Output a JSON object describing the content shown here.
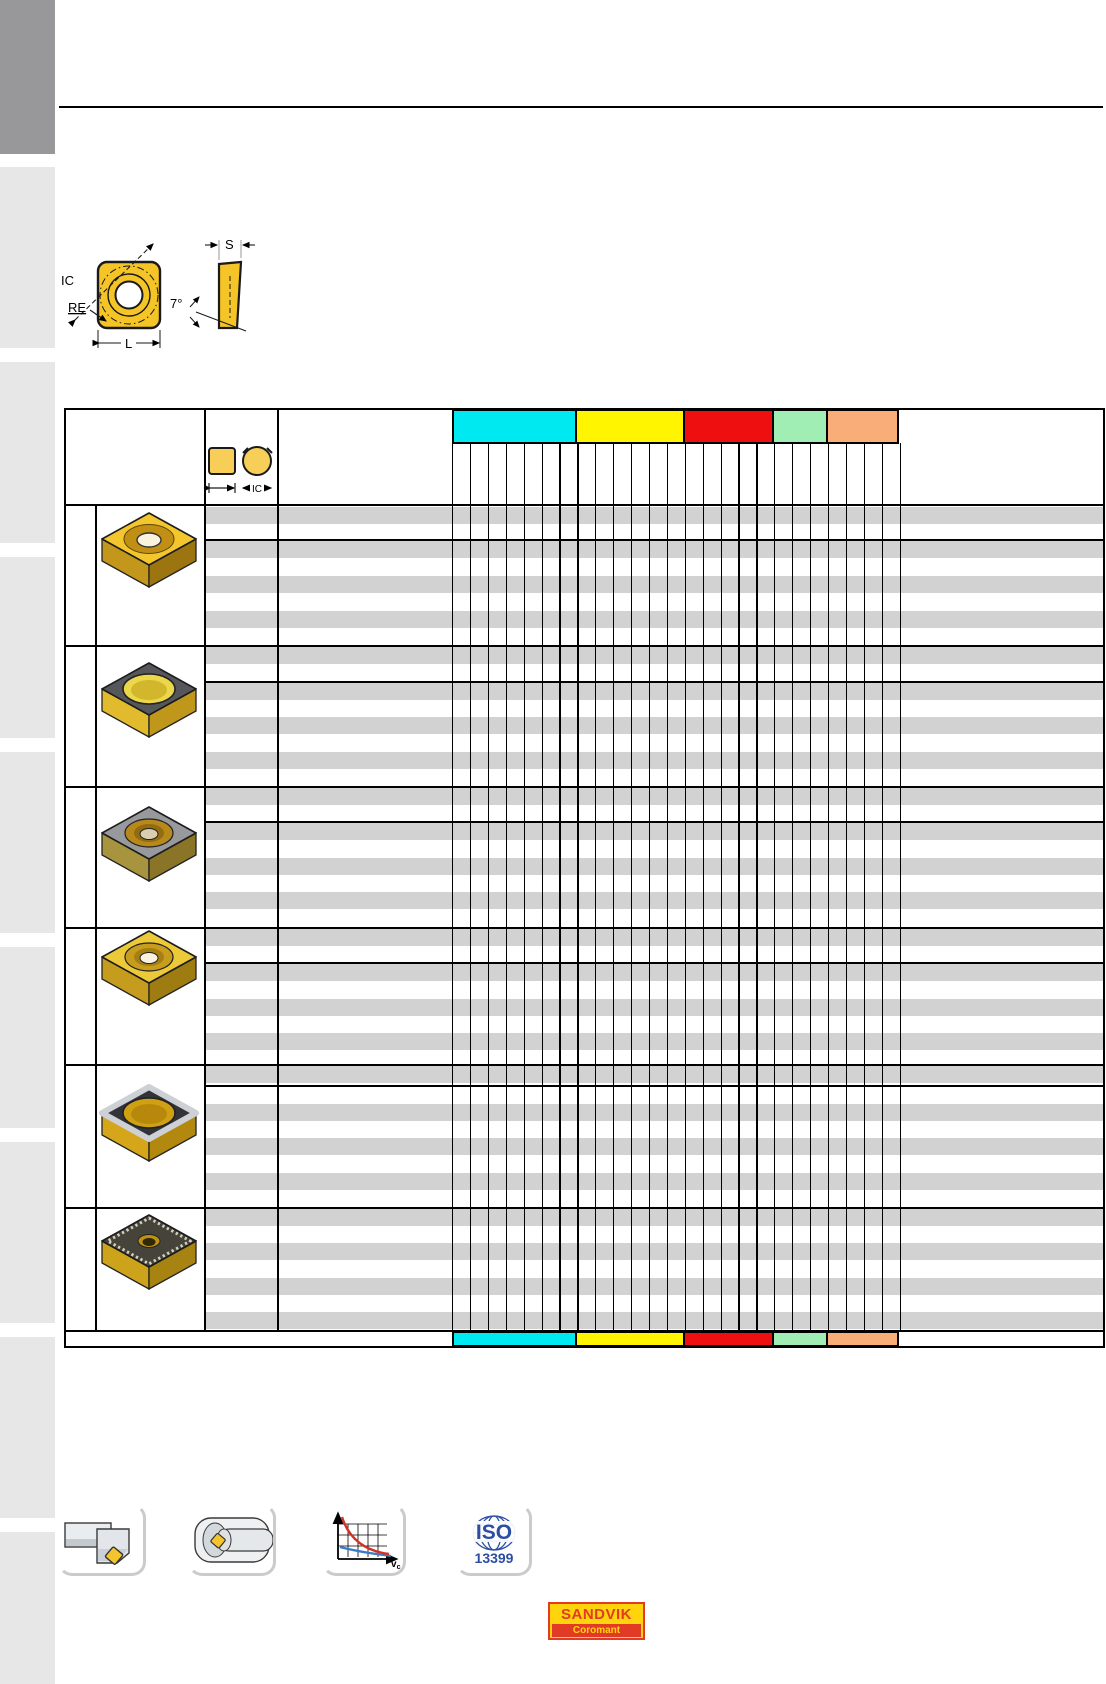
{
  "diagram": {
    "labels": {
      "ic": "IC",
      "re": "RE",
      "l": "L",
      "s": "S",
      "angle": "7°"
    }
  },
  "table": {
    "header_icon_label": "IC",
    "stripe_color": "#d2d2d2",
    "bands": [
      {
        "name": "iso-p",
        "color": "#00e8f0",
        "columns": 7
      },
      {
        "name": "iso-m",
        "color": "#fff500",
        "columns": 6
      },
      {
        "name": "iso-k",
        "color": "#ee1010",
        "columns": 5
      },
      {
        "name": "iso-n",
        "color": "#a0eeb4",
        "columns": 3
      },
      {
        "name": "iso-s",
        "color": "#f9ad79",
        "columns": 4
      }
    ]
  },
  "footer": {
    "chart_icon_label": {
      "main": "v",
      "sub": "c"
    },
    "iso_badge": {
      "title": "ISO",
      "number": "13399"
    }
  },
  "logo": {
    "brand": "SANDVIK",
    "sub": "Coromant"
  }
}
